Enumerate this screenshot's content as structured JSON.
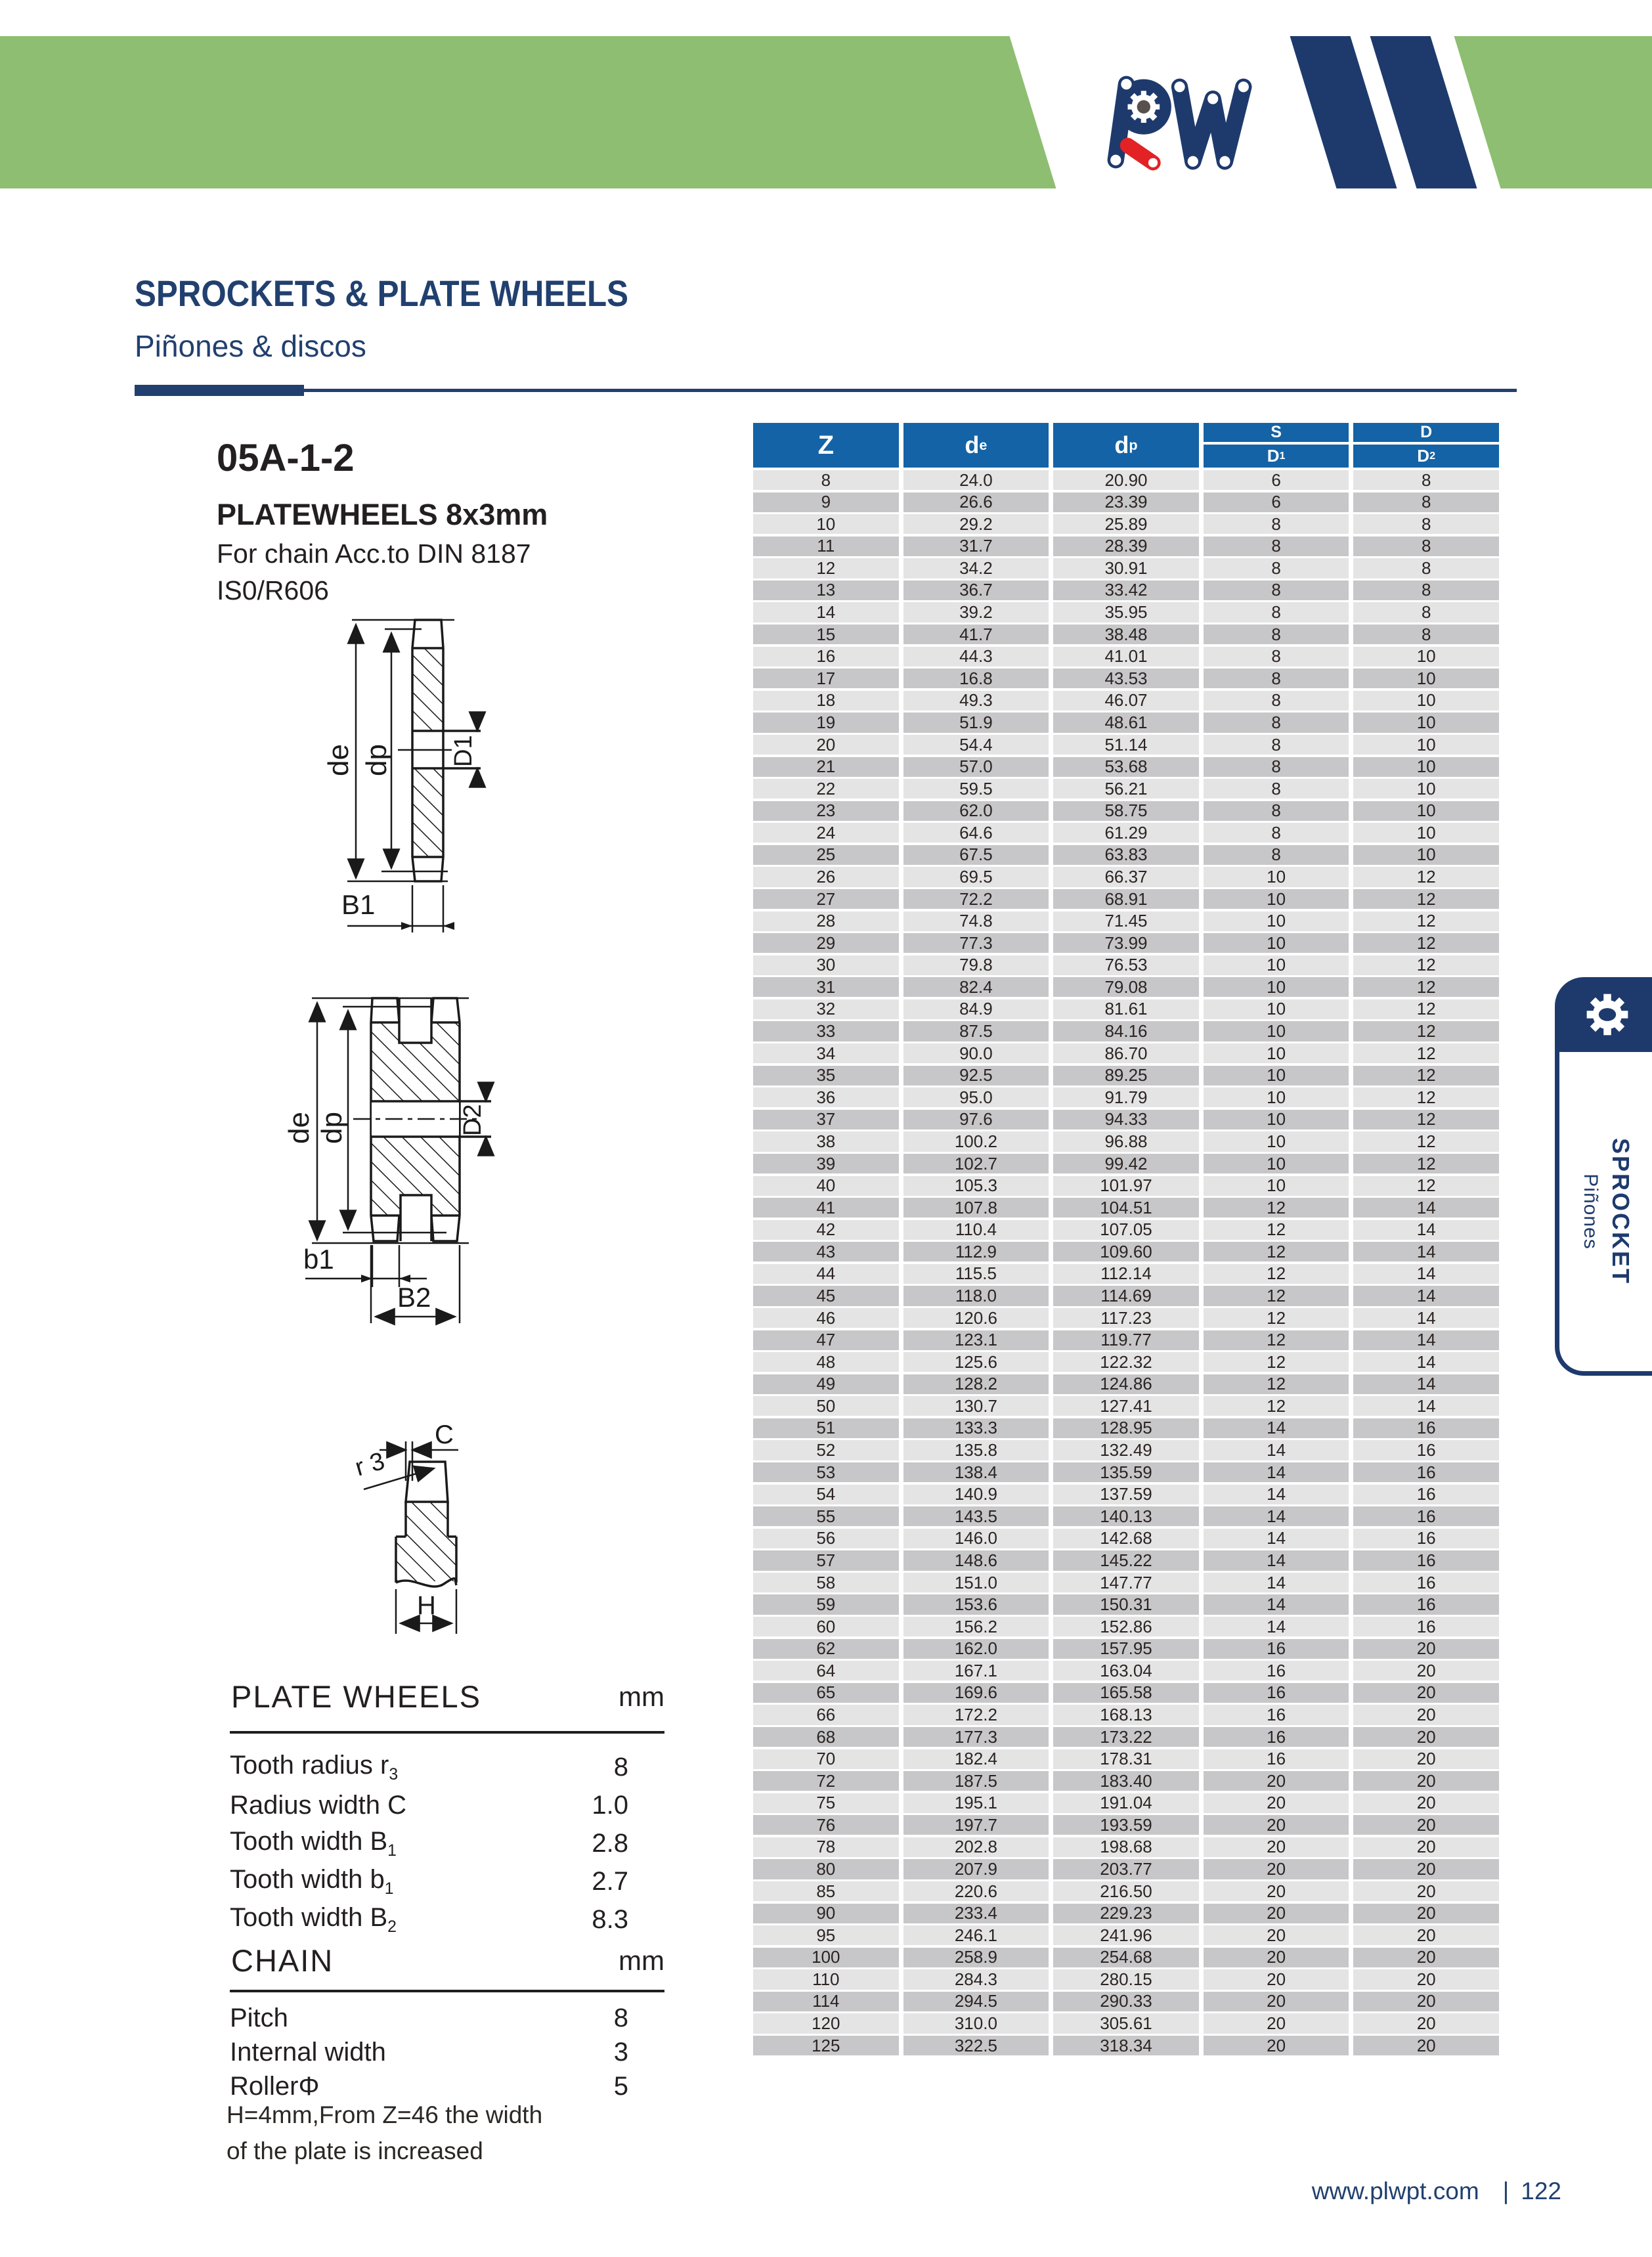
{
  "colors": {
    "navy": "#1e3a6d",
    "green": "#8ebe71",
    "red": "#e32226",
    "table_header_blue": "#1463a6",
    "row_light": "#e4e4e5",
    "row_dark": "#c7c7c9"
  },
  "brand": {
    "logo_text": "PW"
  },
  "header": {
    "title": "SPROCKETS & PLATE WHEELS",
    "subtitle": "Piñones & discos"
  },
  "product": {
    "code": "05A-1-2",
    "name": "PLATEWHEELS 8x3mm",
    "desc_line1": "For chain Acc.to DIN 8187",
    "desc_line2": "IS0/R606"
  },
  "drawings": {
    "single": {
      "de": "de",
      "dp": "dp",
      "d1": "D1",
      "b1": "B1"
    },
    "double": {
      "de": "de",
      "dp": "dp",
      "d2": "D2",
      "b1": "b1",
      "b2": "B2"
    },
    "tooth": {
      "c": "C",
      "r3": "r 3",
      "h": "H"
    }
  },
  "main_table": {
    "col_z": "Z",
    "col_de_base": "d",
    "col_de_sub": "e",
    "col_dp_base": "d",
    "col_dp_sub": "p",
    "col_s": "S",
    "col_d": "D",
    "col_d1_base": "D",
    "col_d1_sub": "1",
    "col_d2_base": "D",
    "col_d2_sub": "2",
    "rows": [
      [
        "8",
        "24.0",
        "20.90",
        "6",
        "8"
      ],
      [
        "9",
        "26.6",
        "23.39",
        "6",
        "8"
      ],
      [
        "10",
        "29.2",
        "25.89",
        "8",
        "8"
      ],
      [
        "11",
        "31.7",
        "28.39",
        "8",
        "8"
      ],
      [
        "12",
        "34.2",
        "30.91",
        "8",
        "8"
      ],
      [
        "13",
        "36.7",
        "33.42",
        "8",
        "8"
      ],
      [
        "14",
        "39.2",
        "35.95",
        "8",
        "8"
      ],
      [
        "15",
        "41.7",
        "38.48",
        "8",
        "8"
      ],
      [
        "16",
        "44.3",
        "41.01",
        "8",
        "10"
      ],
      [
        "17",
        "16.8",
        "43.53",
        "8",
        "10"
      ],
      [
        "18",
        "49.3",
        "46.07",
        "8",
        "10"
      ],
      [
        "19",
        "51.9",
        "48.61",
        "8",
        "10"
      ],
      [
        "20",
        "54.4",
        "51.14",
        "8",
        "10"
      ],
      [
        "21",
        "57.0",
        "53.68",
        "8",
        "10"
      ],
      [
        "22",
        "59.5",
        "56.21",
        "8",
        "10"
      ],
      [
        "23",
        "62.0",
        "58.75",
        "8",
        "10"
      ],
      [
        "24",
        "64.6",
        "61.29",
        "8",
        "10"
      ],
      [
        "25",
        "67.5",
        "63.83",
        "8",
        "10"
      ],
      [
        "26",
        "69.5",
        "66.37",
        "10",
        "12"
      ],
      [
        "27",
        "72.2",
        "68.91",
        "10",
        "12"
      ],
      [
        "28",
        "74.8",
        "71.45",
        "10",
        "12"
      ],
      [
        "29",
        "77.3",
        "73.99",
        "10",
        "12"
      ],
      [
        "30",
        "79.8",
        "76.53",
        "10",
        "12"
      ],
      [
        "31",
        "82.4",
        "79.08",
        "10",
        "12"
      ],
      [
        "32",
        "84.9",
        "81.61",
        "10",
        "12"
      ],
      [
        "33",
        "87.5",
        "84.16",
        "10",
        "12"
      ],
      [
        "34",
        "90.0",
        "86.70",
        "10",
        "12"
      ],
      [
        "35",
        "92.5",
        "89.25",
        "10",
        "12"
      ],
      [
        "36",
        "95.0",
        "91.79",
        "10",
        "12"
      ],
      [
        "37",
        "97.6",
        "94.33",
        "10",
        "12"
      ],
      [
        "38",
        "100.2",
        "96.88",
        "10",
        "12"
      ],
      [
        "39",
        "102.7",
        "99.42",
        "10",
        "12"
      ],
      [
        "40",
        "105.3",
        "101.97",
        "10",
        "12"
      ],
      [
        "41",
        "107.8",
        "104.51",
        "12",
        "14"
      ],
      [
        "42",
        "110.4",
        "107.05",
        "12",
        "14"
      ],
      [
        "43",
        "112.9",
        "109.60",
        "12",
        "14"
      ],
      [
        "44",
        "115.5",
        "112.14",
        "12",
        "14"
      ],
      [
        "45",
        "118.0",
        "114.69",
        "12",
        "14"
      ],
      [
        "46",
        "120.6",
        "117.23",
        "12",
        "14"
      ],
      [
        "47",
        "123.1",
        "119.77",
        "12",
        "14"
      ],
      [
        "48",
        "125.6",
        "122.32",
        "12",
        "14"
      ],
      [
        "49",
        "128.2",
        "124.86",
        "12",
        "14"
      ],
      [
        "50",
        "130.7",
        "127.41",
        "12",
        "14"
      ],
      [
        "51",
        "133.3",
        "128.95",
        "14",
        "16"
      ],
      [
        "52",
        "135.8",
        "132.49",
        "14",
        "16"
      ],
      [
        "53",
        "138.4",
        "135.59",
        "14",
        "16"
      ],
      [
        "54",
        "140.9",
        "137.59",
        "14",
        "16"
      ],
      [
        "55",
        "143.5",
        "140.13",
        "14",
        "16"
      ],
      [
        "56",
        "146.0",
        "142.68",
        "14",
        "16"
      ],
      [
        "57",
        "148.6",
        "145.22",
        "14",
        "16"
      ],
      [
        "58",
        "151.0",
        "147.77",
        "14",
        "16"
      ],
      [
        "59",
        "153.6",
        "150.31",
        "14",
        "16"
      ],
      [
        "60",
        "156.2",
        "152.86",
        "14",
        "16"
      ],
      [
        "62",
        "162.0",
        "157.95",
        "16",
        "20"
      ],
      [
        "64",
        "167.1",
        "163.04",
        "16",
        "20"
      ],
      [
        "65",
        "169.6",
        "165.58",
        "16",
        "20"
      ],
      [
        "66",
        "172.2",
        "168.13",
        "16",
        "20"
      ],
      [
        "68",
        "177.3",
        "173.22",
        "16",
        "20"
      ],
      [
        "70",
        "182.4",
        "178.31",
        "16",
        "20"
      ],
      [
        "72",
        "187.5",
        "183.40",
        "20",
        "20"
      ],
      [
        "75",
        "195.1",
        "191.04",
        "20",
        "20"
      ],
      [
        "76",
        "197.7",
        "193.59",
        "20",
        "20"
      ],
      [
        "78",
        "202.8",
        "198.68",
        "20",
        "20"
      ],
      [
        "80",
        "207.9",
        "203.77",
        "20",
        "20"
      ],
      [
        "85",
        "220.6",
        "216.50",
        "20",
        "20"
      ],
      [
        "90",
        "233.4",
        "229.23",
        "20",
        "20"
      ],
      [
        "95",
        "246.1",
        "241.96",
        "20",
        "20"
      ],
      [
        "100",
        "258.9",
        "254.68",
        "20",
        "20"
      ],
      [
        "110",
        "284.3",
        "280.15",
        "20",
        "20"
      ],
      [
        "114",
        "294.5",
        "290.33",
        "20",
        "20"
      ],
      [
        "120",
        "310.0",
        "305.61",
        "20",
        "20"
      ],
      [
        "125",
        "322.5",
        "318.34",
        "20",
        "20"
      ]
    ]
  },
  "plate_wheels": {
    "title": "PLATE  WHEELS",
    "unit": "mm",
    "rows": [
      {
        "label": "Tooth radius r",
        "sub": "3",
        "value": "8"
      },
      {
        "label": "Radius width C",
        "sub": "",
        "value": "1.0"
      },
      {
        "label": "Tooth width B",
        "sub": "1",
        "value": "2.8"
      },
      {
        "label": "Tooth width b",
        "sub": "1",
        "value": "2.7"
      },
      {
        "label": "Tooth width B",
        "sub": "2",
        "value": "8.3"
      }
    ]
  },
  "chain": {
    "title": "CHAIN",
    "unit": "mm",
    "rows": [
      {
        "label": "Pitch",
        "sub": "",
        "value": "8"
      },
      {
        "label": "Internal width",
        "sub": "",
        "value": "3"
      },
      {
        "label": "RollerΦ",
        "sub": "",
        "value": "5"
      }
    ]
  },
  "note": {
    "line1": "H=4mm,From Z=46 the width",
    "line2": "of the plate is increased"
  },
  "footer": {
    "url": "www.plwpt.com",
    "divider": "|",
    "page": "122"
  },
  "side_tab": {
    "title": "SPROCKET",
    "subtitle": "Piñones"
  }
}
